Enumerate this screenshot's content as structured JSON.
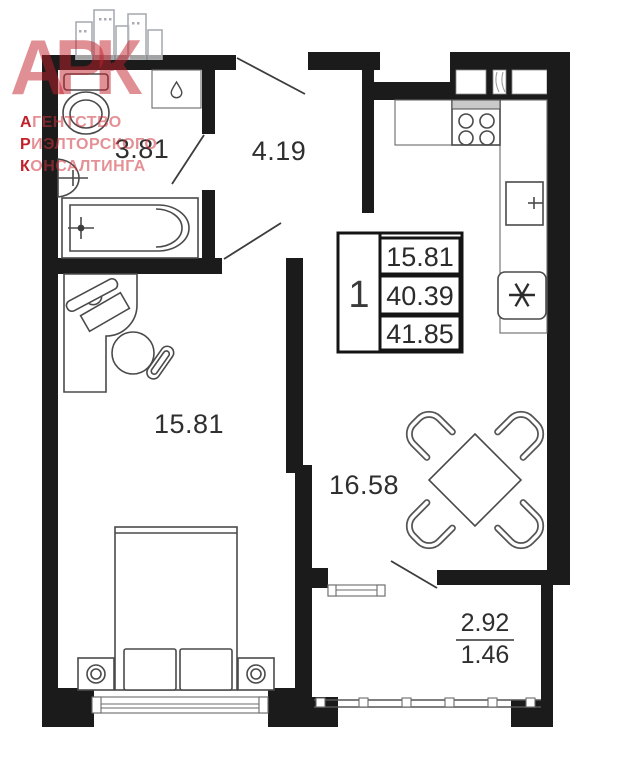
{
  "watermark": {
    "logo_text": "АРК",
    "lines": [
      "АГЕНТСТВО",
      "РИЭЛТОРСКОГО",
      "КОНСАЛТИНГА"
    ],
    "brand_color": "#C2202A"
  },
  "plan": {
    "rooms": {
      "bathroom": {
        "area": "3.81"
      },
      "hallway": {
        "area": "4.19"
      },
      "bedroom": {
        "area": "15.81"
      },
      "kitchen_living": {
        "area": "16.58"
      },
      "balcony": {
        "area_full": "2.92",
        "area_reduced": "1.46"
      }
    },
    "stamp": {
      "room_count": "1",
      "living_area": "15.81",
      "apartment_area": "40.39",
      "total_area": "41.85"
    },
    "furniture_icons": [
      "toilet-icon",
      "washing-machine-icon",
      "washbasin-icon",
      "bathtub-icon",
      "desk-icon",
      "laptop-icon",
      "office-chair-icon",
      "bed-icon",
      "nightstand-icon",
      "dining-table-icon",
      "dining-chair-icon",
      "kitchen-counter-icon",
      "stove-icon",
      "kitchen-sink-icon",
      "refrigerator-icon",
      "balcony-railing-icon",
      "window-icon",
      "door-swing-icon",
      "vent-shaft-icon",
      "buildings-logo-icon",
      "water-drop-icon"
    ],
    "wall_color": "#1b1b1b"
  }
}
